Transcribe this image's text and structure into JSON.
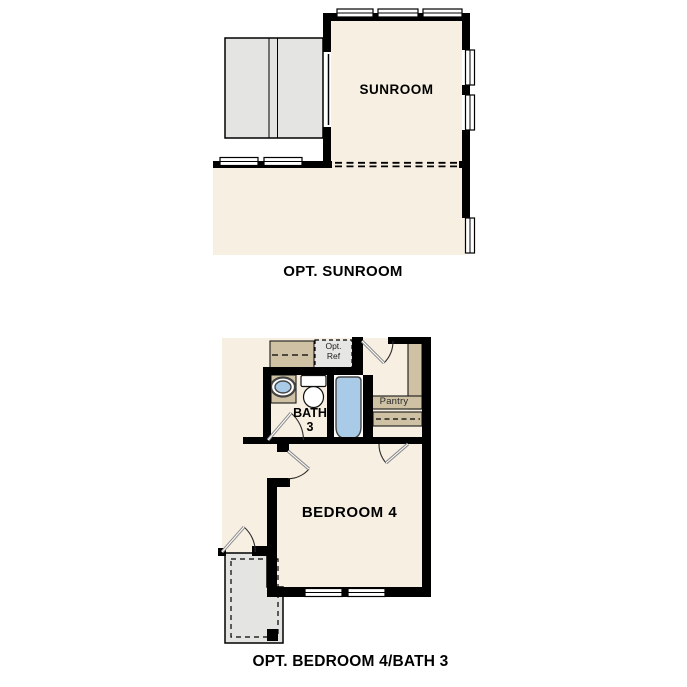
{
  "figure_type": "floor-plan-option-diagrams",
  "sunroom_plan": {
    "room_label": "SUNROOM",
    "caption": "OPT. SUNROOM"
  },
  "bedroom_plan": {
    "opt_ref_line1": "Opt.",
    "opt_ref_line2": "Ref",
    "pantry_label": "Pantry",
    "bath_line1": "BATH",
    "bath_line2": "3",
    "bedroom_label": "BEDROOM 4",
    "caption": "OPT. BEDROOM 4/BATH 3"
  },
  "colors": {
    "background": "#ffffff",
    "floor_fill": "#F7EFE1",
    "wall": "#000000",
    "counter_tan": "#CFC1A4",
    "fixture_blue": "#A9CBE8",
    "patio_gray": "#E4E4E2",
    "door_panel_gray": "#8C8C8C"
  }
}
